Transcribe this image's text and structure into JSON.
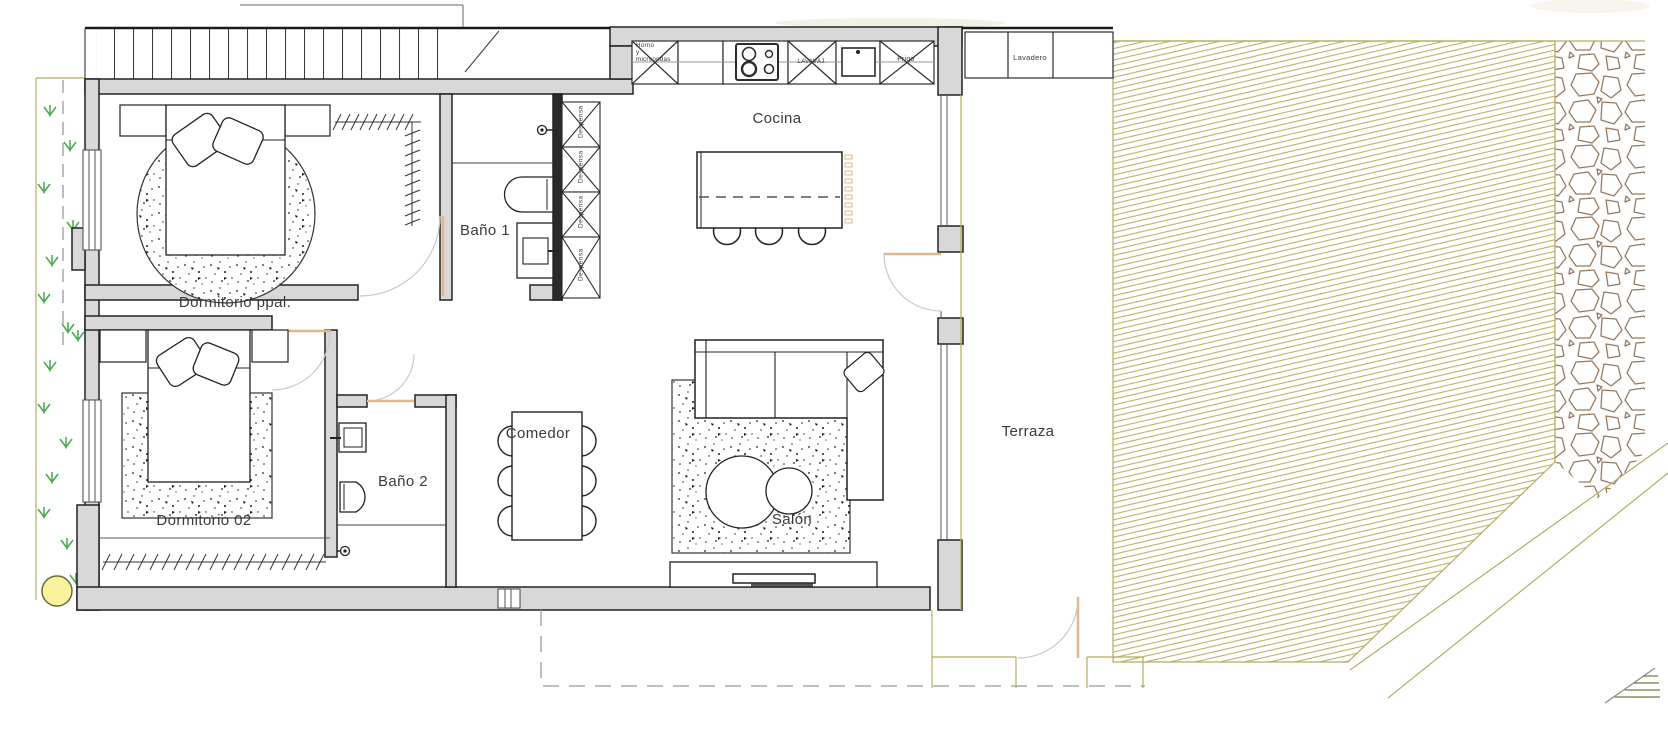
{
  "rooms": {
    "dormitorio_ppal": "Dormitorio ppal.",
    "bano1": "Baño 1",
    "cocina": "Cocina",
    "comedor": "Comedor",
    "bano2": "Baño 2",
    "dormitorio02": "Dormitorio 02",
    "salon": "Salón",
    "terraza": "Terraza"
  },
  "kitchen_fixtures": {
    "horno": "Horno\ny\nmicroondas",
    "lavavajillas": "LAVAVAJ.",
    "frigo": "Frigo"
  },
  "storage": {
    "despensa": "Despensa",
    "lavadero": "Lavadero"
  },
  "colors": {
    "wall_fill": "#d8d8d8",
    "line": "#222222",
    "lawn_olive": "#b3ad5c",
    "door_tan": "#ddb98c",
    "stone_brown": "#97795f",
    "grass_green": "#49a94e",
    "tree_yellow": "#f7f29b",
    "door_arc_gray": "#c9c9c9",
    "boundary_dash_gray": "#a8a8a8"
  }
}
